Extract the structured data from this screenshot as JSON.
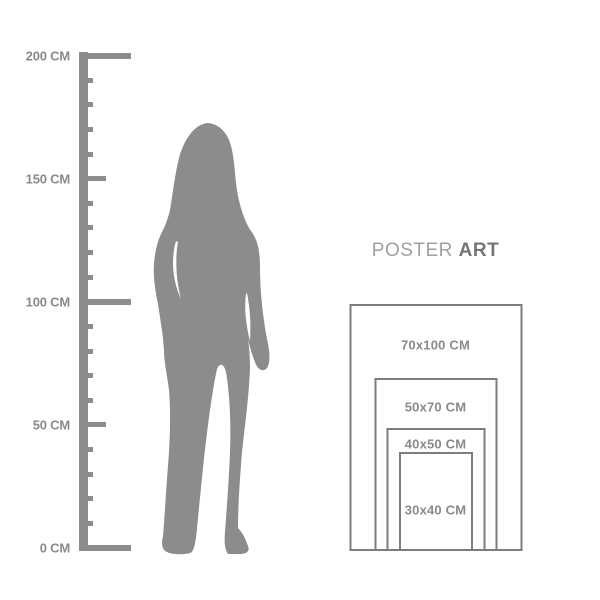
{
  "colors": {
    "background": "#ffffff",
    "silhouette": "#8c8c8c",
    "ruler": "#8c8c8c",
    "ruler_label": "#8a8a8a",
    "rect_border": "#7d7d7d",
    "rect_label": "#8a8a8a",
    "title_regular": "#a0a0a0",
    "title_bold": "#757575"
  },
  "title": {
    "regular": "POSTER",
    "bold": "ART"
  },
  "ruler": {
    "unit": "CM",
    "min_cm": 0,
    "max_cm": 200,
    "minor_step_cm": 10,
    "long_tick_cm": [
      0,
      100,
      200
    ],
    "medium_tick_cm": [
      50,
      150
    ],
    "labels": [
      {
        "cm": 200,
        "text": "200 CM"
      },
      {
        "cm": 150,
        "text": "150 CM"
      },
      {
        "cm": 100,
        "text": "100 CM"
      },
      {
        "cm": 50,
        "text": "50 CM"
      },
      {
        "cm": 0,
        "text": "0 CM"
      }
    ]
  },
  "figure": {
    "type": "standing-woman-silhouette"
  },
  "poster_sizes": [
    {
      "width_cm": 70,
      "height_cm": 100,
      "label": "70x100 CM"
    },
    {
      "width_cm": 50,
      "height_cm": 70,
      "label": "50x70 CM"
    },
    {
      "width_cm": 40,
      "height_cm": 50,
      "label": "40x50 CM"
    },
    {
      "width_cm": 30,
      "height_cm": 40,
      "label": "30x40 CM"
    }
  ]
}
